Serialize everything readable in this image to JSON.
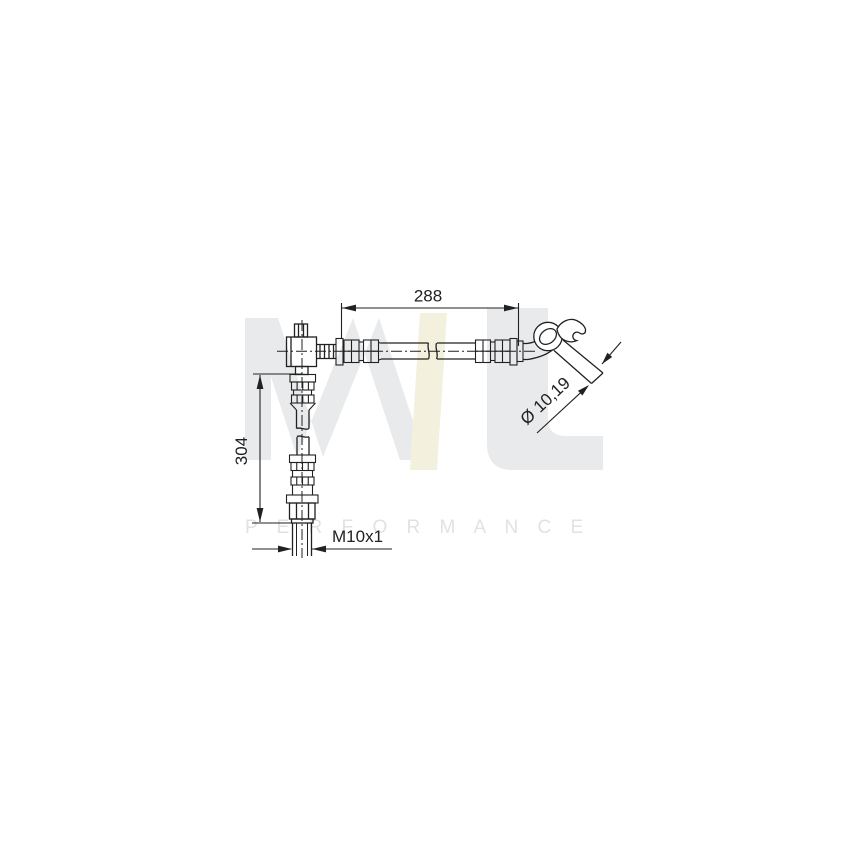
{
  "image": {
    "type": "technical line drawing",
    "subject": "brake hose with end fittings",
    "background_color": "#ffffff",
    "line_color": "#212121"
  },
  "dimensions": {
    "horizontal_length": "288",
    "vertical_length": "304",
    "thread_size": "M10x1",
    "diameter": "Ø 10,19"
  },
  "watermark": {
    "logo_text": "ML",
    "performance_text": "P E R F O R M A N C E",
    "logo_gray": "#e9eaec",
    "logo_yellow": "#f3f0dd",
    "text_color": "#e2e2e2"
  }
}
